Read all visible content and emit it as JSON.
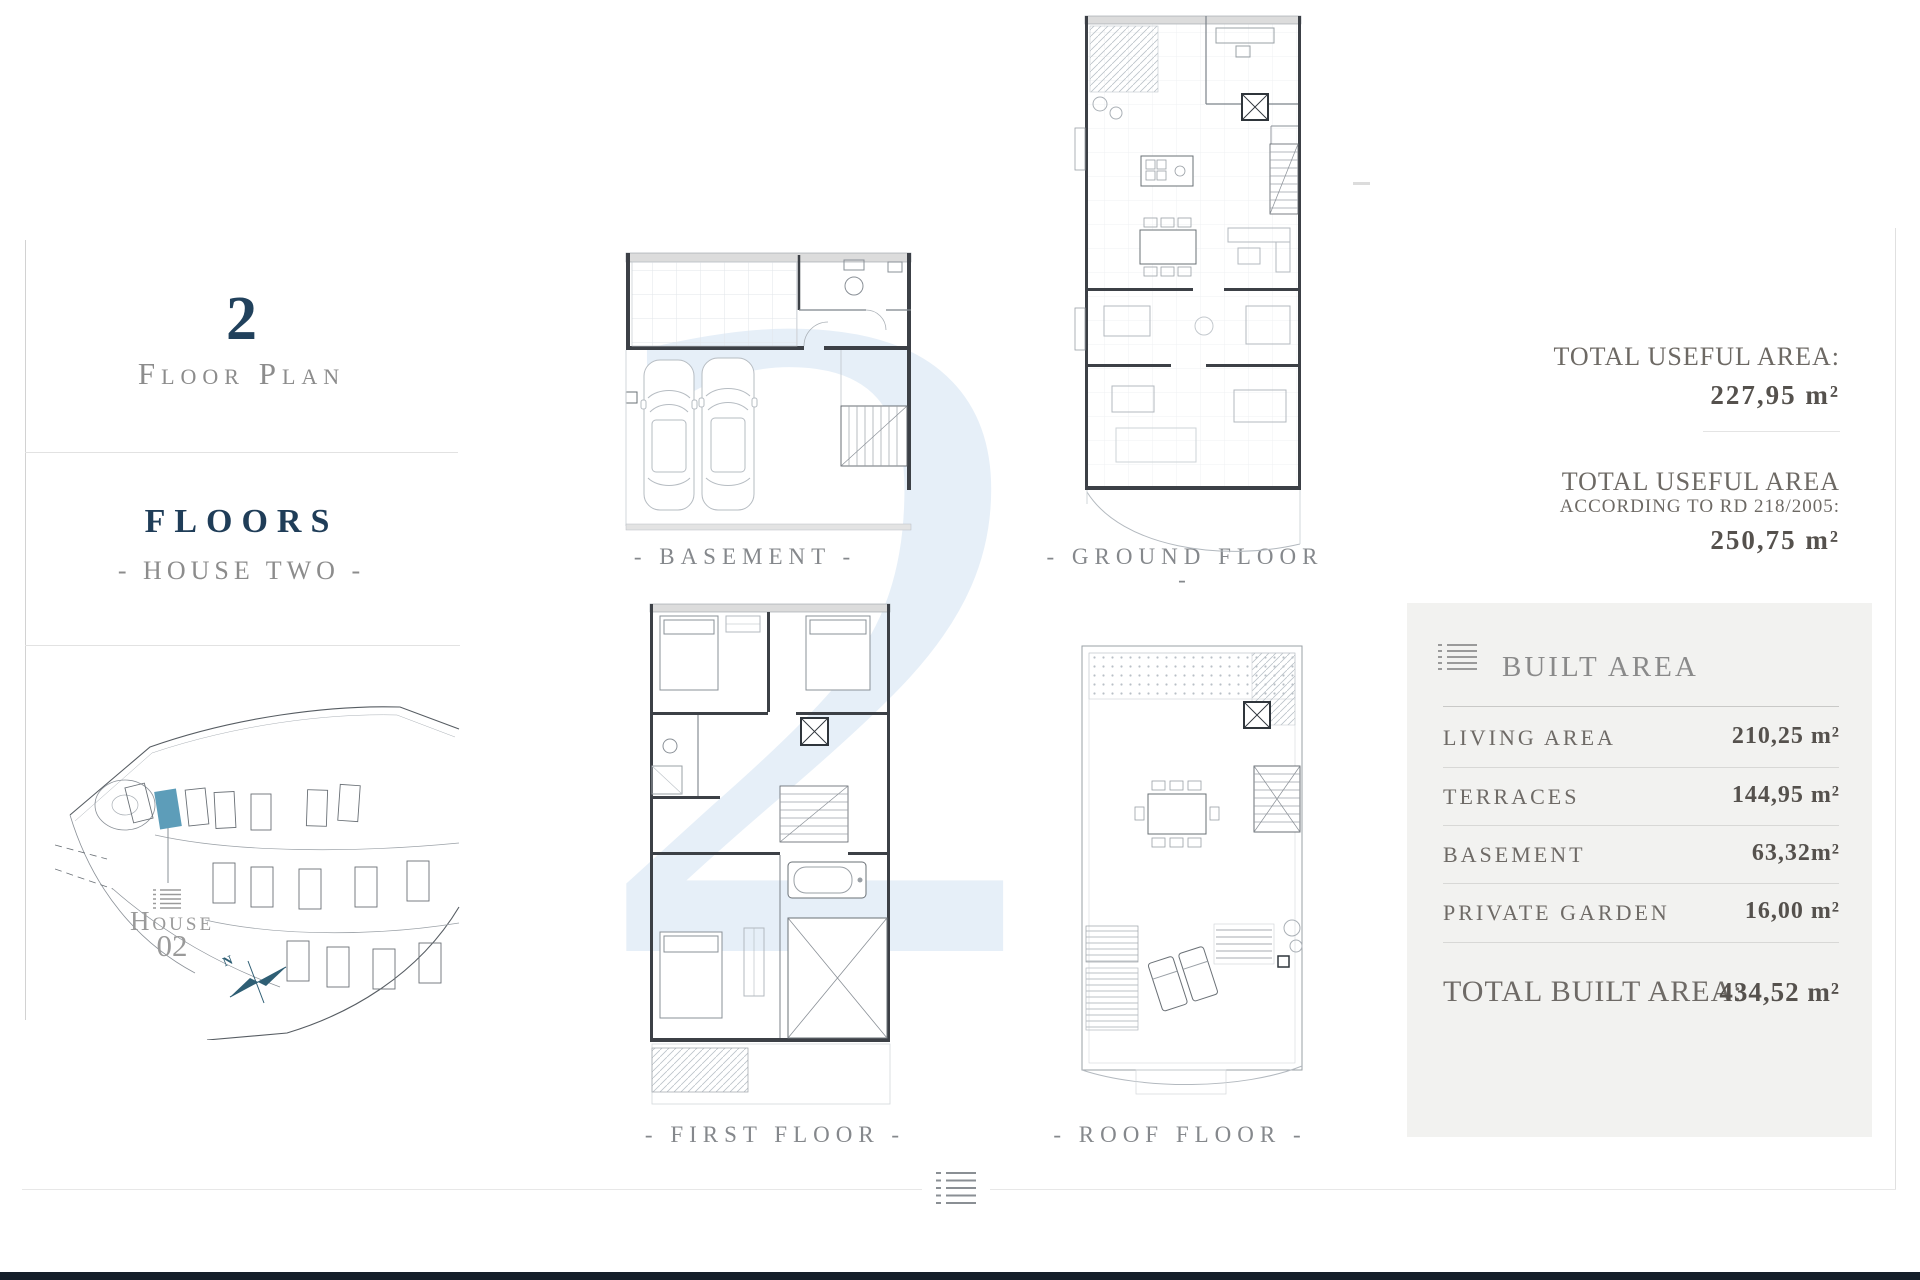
{
  "sidebar": {
    "number": "2",
    "subtitle": "Floor Plan",
    "section_title": "FLOORS",
    "section_subtitle": "- HOUSE TWO -",
    "site_label_line1": "House",
    "site_label_line2": "02",
    "compass_n": "N"
  },
  "watermark": "2",
  "plans": {
    "basement_label": "- BASEMENT -",
    "ground_label": "- GROUND FLOOR -",
    "first_label": "- FIRST FLOOR -",
    "roof_label": "- ROOF FLOOR -"
  },
  "useful_area": {
    "block1_title": "TOTAL USEFUL AREA:",
    "block1_value": "227,95 m²",
    "block2_title_line1": "TOTAL USEFUL AREA",
    "block2_title_line2": "ACCORDING TO RD 218/2005:",
    "block2_value": "250,75 m²"
  },
  "built_area": {
    "title": "BUILT AREA",
    "rows": [
      {
        "label": "LIVING AREA",
        "value": "210,25 m²"
      },
      {
        "label": "TERRACES",
        "value": "144,95 m²"
      },
      {
        "label": "BASEMENT",
        "value": "63,32m²"
      },
      {
        "label": "PRIVATE GARDEN",
        "value": "16,00 m²"
      }
    ],
    "total_label": "TOTAL BUILT AREA:",
    "total_value": "434,52 m²"
  },
  "colors": {
    "navy": "#21415c",
    "gray_text": "#8c8c8c",
    "label_gray": "#6e6a66",
    "value_dark": "#55514d",
    "panel_bg": "#f2f2f0",
    "watermark_blue": "#e6eff8",
    "highlight_house": "#5d9db9",
    "bottom_bar": "#141e29"
  }
}
